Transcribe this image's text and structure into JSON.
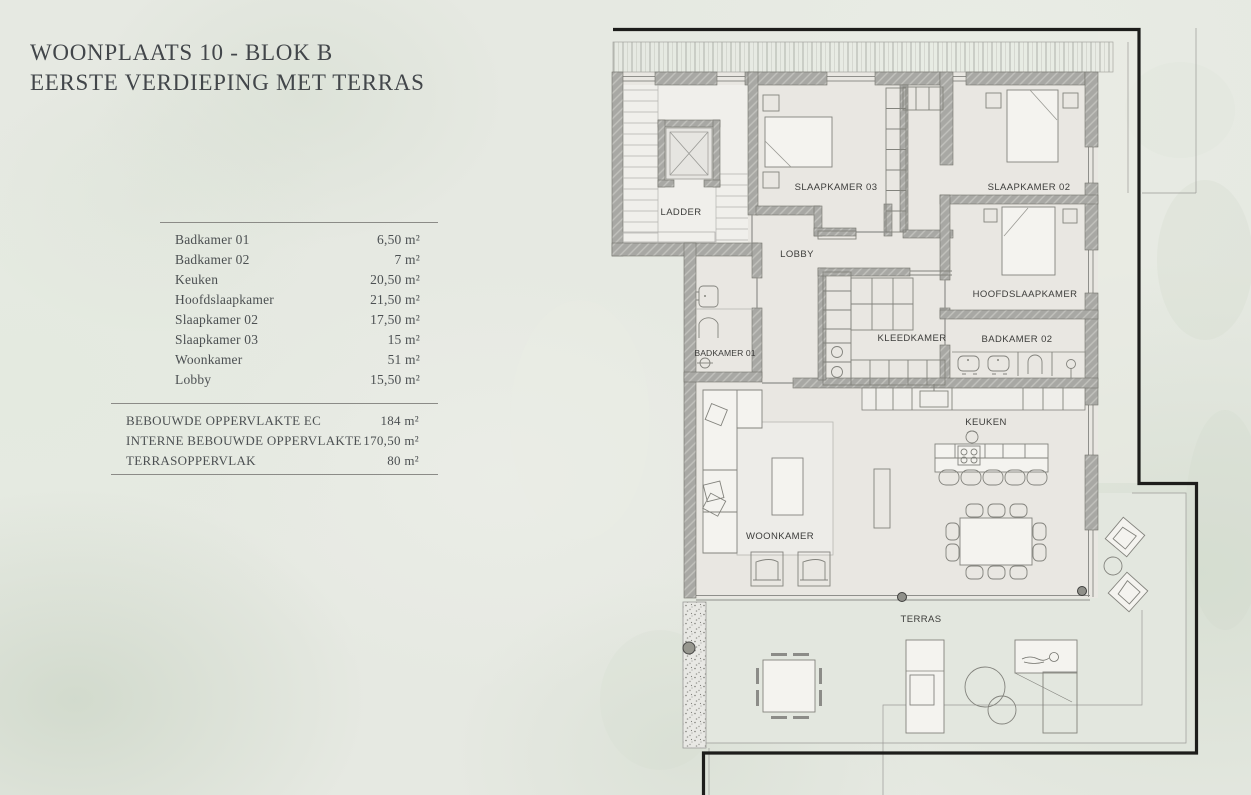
{
  "header": {
    "title_line1": "WOONPLAATS 10 - BLOK B",
    "title_line2": "EERSTE VERDIEPING MET TERRAS"
  },
  "legend": {
    "rows": [
      {
        "name": "Badkamer 01",
        "area": "6,50 m²"
      },
      {
        "name": "Badkamer 02",
        "area": "7 m²"
      },
      {
        "name": "Keuken",
        "area": "20,50 m²"
      },
      {
        "name": "Hoofdslaapkamer",
        "area": "21,50 m²"
      },
      {
        "name": "Slaapkamer 02",
        "area": "17,50 m²"
      },
      {
        "name": "Slaapkamer 03",
        "area": "15 m²"
      },
      {
        "name": "Woonkamer",
        "area": "51 m²"
      },
      {
        "name": "Lobby",
        "area": "15,50 m²"
      }
    ],
    "summary": [
      {
        "name": "BEBOUWDE OPPERVLAKTE EC",
        "area": "184 m²"
      },
      {
        "name": "INTERNE BEBOUWDE OPPERVLAKTE",
        "area": "170,50 m²"
      },
      {
        "name": "TERRASOPPERVLAK",
        "area": "80 m²"
      }
    ]
  },
  "plan": {
    "rooms": [
      {
        "id": "ladder",
        "label": "LADDER"
      },
      {
        "id": "slaapkamer-03",
        "label": "SLAAPKAMER 03"
      },
      {
        "id": "slaapkamer-02",
        "label": "SLAAPKAMER 02"
      },
      {
        "id": "lobby",
        "label": "LOBBY"
      },
      {
        "id": "hoofdslaapkamer",
        "label": "HOOFDSLAAPKAMER"
      },
      {
        "id": "badkamer-01",
        "label": "BADKAMER 01"
      },
      {
        "id": "kleedkamer",
        "label": "KLEEDKAMER"
      },
      {
        "id": "badkamer-02",
        "label": "BADKAMER 02"
      },
      {
        "id": "keuken",
        "label": "KEUKEN"
      },
      {
        "id": "woonkamer",
        "label": "WOONKAMER"
      },
      {
        "id": "terras",
        "label": "TERRAS"
      }
    ],
    "colors": {
      "outline": "#1d1d1b",
      "wall": "#a8a8a4",
      "floor": "#e9e7e2",
      "terrace_floor": "#e3e7df",
      "background": "#e6e9e2"
    }
  }
}
